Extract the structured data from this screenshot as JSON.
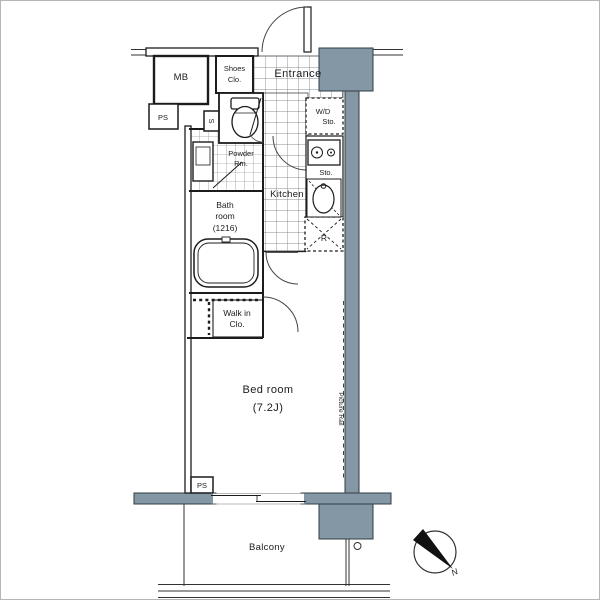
{
  "colors": {
    "wall": "#8497a4",
    "line": "#1c1c1c"
  },
  "labels": {
    "mb": "MB",
    "shoes1": "Shoes",
    "shoes2": "Clo.",
    "entrance": "Entrance",
    "ps_top": "PS",
    "sbox": "S",
    "wd1": "W/D",
    "wd2": "Sto.",
    "powder1": "Powder",
    "powder2": "Rm.",
    "bath1": "Bath",
    "bath2": "room",
    "bath3": "(1216)",
    "kitchen": "Kitchen",
    "sto": "Sto.",
    "fridge": "R",
    "walkin1": "Walk in",
    "walkin2": "Clo.",
    "bed1": "Bed room",
    "bed2": "(7.2J)",
    "picture_rail": "Picture Rail",
    "ps_bottom": "PS",
    "balcony": "Balcony",
    "north": "N"
  }
}
